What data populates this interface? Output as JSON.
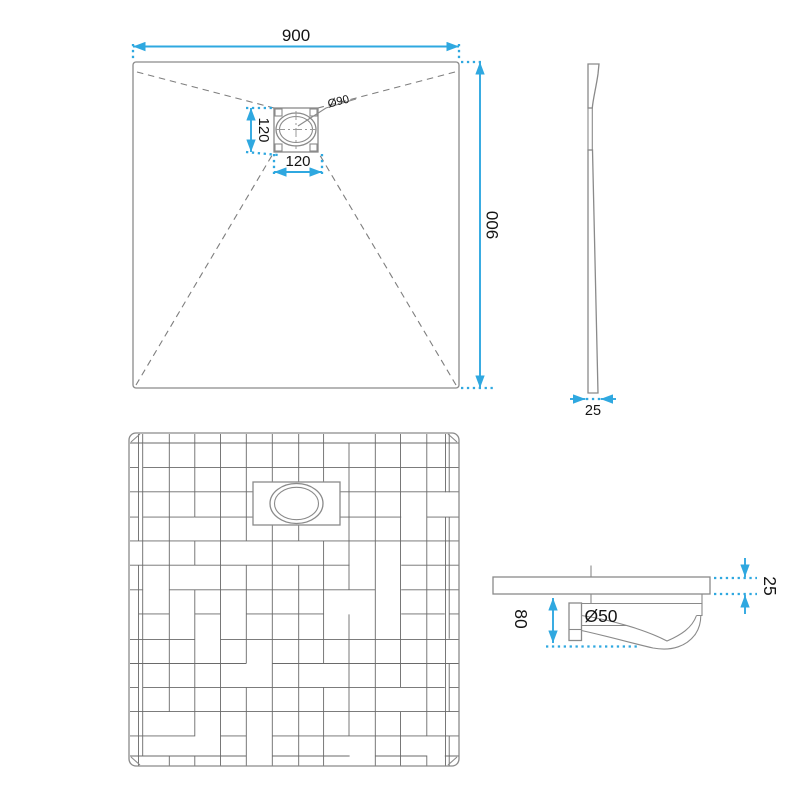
{
  "colors": {
    "accent": "#2fa8e0",
    "line": "#8a8a8a",
    "grid": "#6a6a6a"
  },
  "plan_view": {
    "width_dim": "900",
    "height_dim": "900",
    "drain_width_dim": "120",
    "drain_height_dim": "120",
    "drain_diameter": "Ø90"
  },
  "side_view": {
    "thickness_dim": "25"
  },
  "section_view": {
    "trap_depth_dim": "80",
    "edge_thickness_dim": "25",
    "outlet_diameter": "Ø50"
  }
}
